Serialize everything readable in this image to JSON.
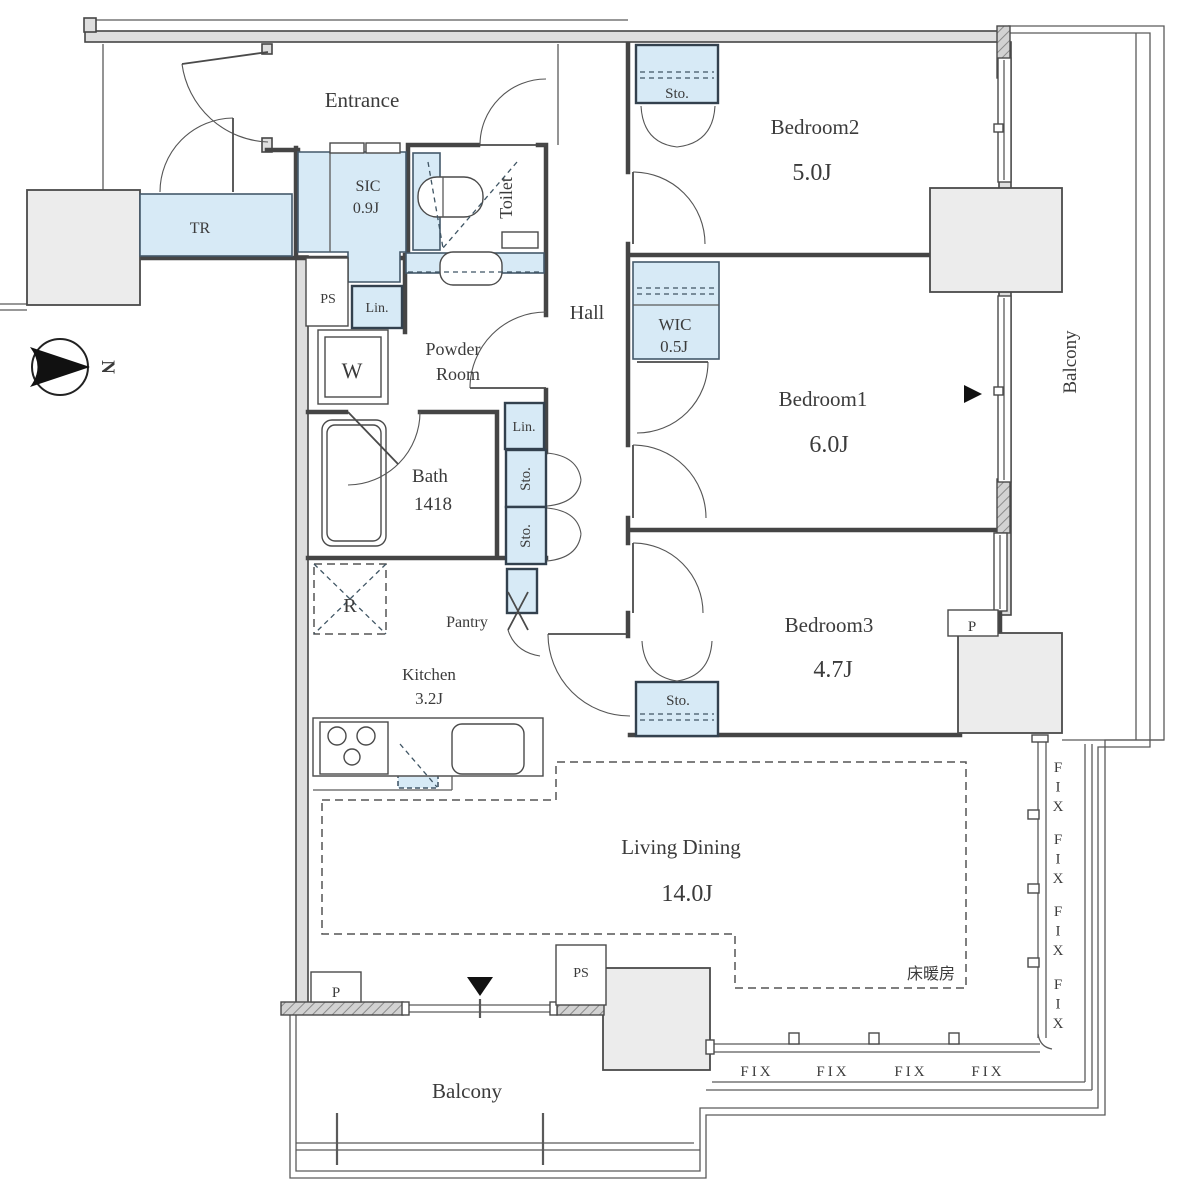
{
  "plan": {
    "compass_north": "N",
    "colors": {
      "closet_fill": "#d7eaf6",
      "pillar_fill": "#ececec",
      "wall": "#454545"
    },
    "rooms": {
      "entrance": "Entrance",
      "hall": "Hall",
      "toilet": "Toilet",
      "tr": "TR",
      "sic": {
        "name": "SIC",
        "size": "0.9J"
      },
      "powder_room": {
        "line1": "Powder",
        "line2": "Room"
      },
      "bath": {
        "name": "Bath",
        "size": "1418"
      },
      "kitchen": {
        "name": "Kitchen",
        "size": "3.2J"
      },
      "pantry": "Pantry",
      "living_dining": {
        "name": "Living Dining",
        "size": "14.0J"
      },
      "bedroom1": {
        "name": "Bedroom1",
        "size": "6.0J"
      },
      "bedroom2": {
        "name": "Bedroom2",
        "size": "5.0J"
      },
      "bedroom3": {
        "name": "Bedroom3",
        "size": "4.7J"
      },
      "wic": {
        "name": "WIC",
        "size": "0.5J"
      },
      "balcony_side": "Balcony",
      "balcony_bottom": "Balcony"
    },
    "labels": {
      "storage": "Sto.",
      "linen": "Lin.",
      "washer": "W",
      "refrigerator": "R",
      "pipe_space": "PS",
      "pillar": "P",
      "fixed_window": "FIX",
      "floor_heating": "床暖房"
    }
  }
}
